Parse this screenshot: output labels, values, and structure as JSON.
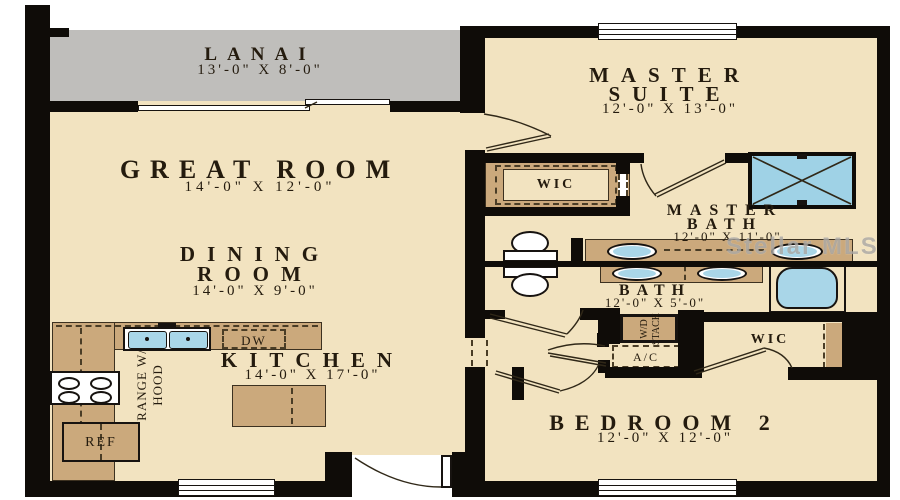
{
  "watermark": "Stellar MLS",
  "rooms": {
    "lanai": {
      "name": "LANAI",
      "dims": "13'-0\" X 8'-0\""
    },
    "great_room": {
      "name": "GREAT ROOM",
      "dims": "14'-0\" X 12'-0\""
    },
    "dining_room": {
      "line1": "DINING",
      "line2": "ROOM",
      "dims": "14'-0\" X 9'-0\""
    },
    "kitchen": {
      "name": "KITCHEN",
      "dims": "14'-0\" X 17'-0\""
    },
    "master_suite": {
      "line1": "MASTER",
      "line2": "SUITE",
      "dims": "12'-0\" X 13'-0\""
    },
    "master_bath": {
      "line1": "MASTER",
      "line2": "BATH",
      "dims": "12'-0\" X 11'-0\""
    },
    "bath": {
      "name": "BATH",
      "dims": "12'-0\" X 5'-0\""
    },
    "bedroom2": {
      "name": "BEDROOM 2",
      "dims": "12'-0\" X 12'-0\""
    },
    "master_wic": {
      "name": "WIC"
    },
    "bedroom2_wic": {
      "name": "WIC"
    }
  },
  "fixtures": {
    "dishwasher": "DW",
    "refrigerator": "REF",
    "range_line1": "RANGE W/",
    "range_line2": "HOOD",
    "wd_line1": "W/D",
    "wd_line2": "STACK",
    "ac": "A/C"
  },
  "colors": {
    "wall": "#0f0c08",
    "floor": "#f2e3c0",
    "lanai": "#bfbebb",
    "cabinet": "#cba97c",
    "fixture_blue": "#a9d6e8",
    "label_text": "#241b0e",
    "watermark": "#969390"
  }
}
